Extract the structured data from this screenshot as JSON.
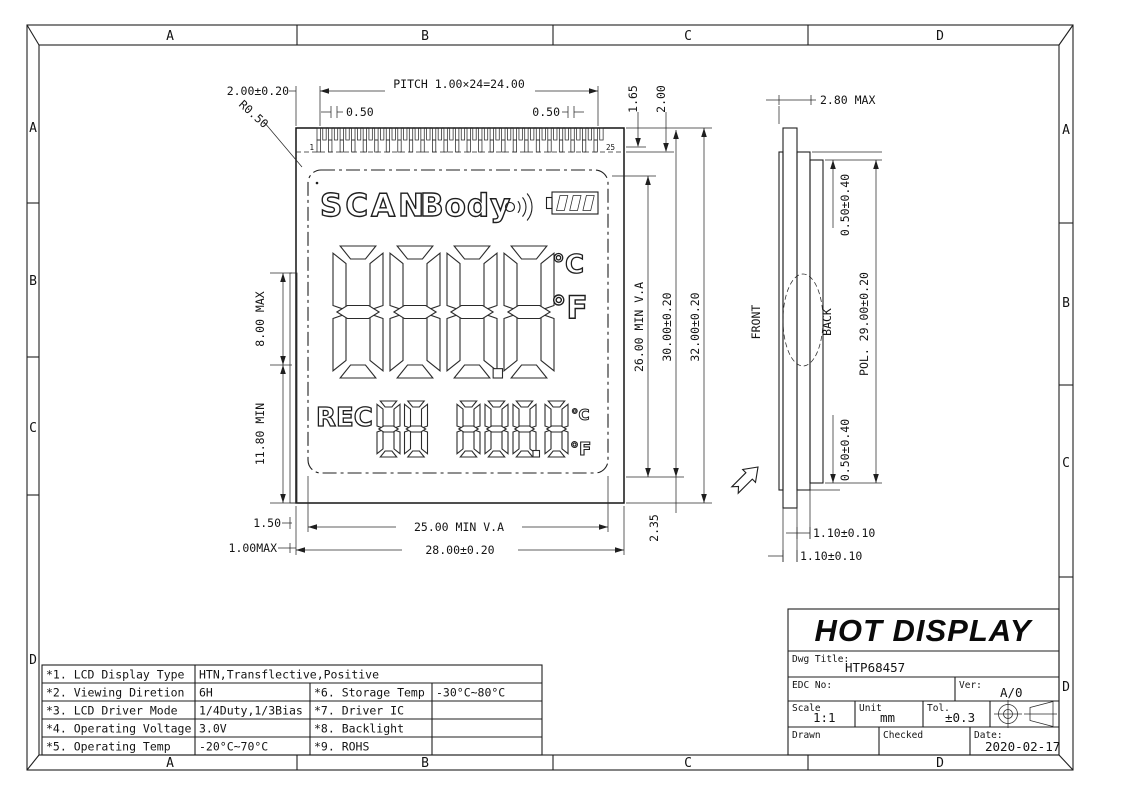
{
  "zones": {
    "top": [
      "A",
      "B",
      "C",
      "D"
    ],
    "bottom": [
      "A",
      "B",
      "C",
      "D"
    ],
    "left": [
      "A",
      "B",
      "C",
      "D"
    ],
    "right": [
      "A",
      "B",
      "C",
      "D"
    ]
  },
  "front_dims": {
    "edge": "2.00±0.20",
    "pitch": "PITCH 1.00×24=24.00",
    "pinw_l": "0.50",
    "pinw_r": "0.50",
    "radius": "R0.50",
    "d165": "1.65",
    "d200": "2.00",
    "h8": "8.00 MAX",
    "h118": "11.80 MIN",
    "d15": "1.50",
    "d1max": "1.00MAX",
    "va_w": "25.00 MIN V.A",
    "w28": "28.00±0.20",
    "va_h": "26.00 MIN V.A",
    "h30": "30.00±0.20",
    "h32": "32.00±0.20",
    "d235": "2.35",
    "pin_first": "1",
    "pin_last": "25"
  },
  "lcd": {
    "scan": "SCAN",
    "body": "Body",
    "rec": "REC",
    "main_digits": "888.8",
    "sub_digits_left": "88",
    "sub_digits_right": "888.8",
    "unit_c_large": "°C",
    "unit_f_large": "°F",
    "unit_c_small": "°C",
    "unit_f_small": "°F",
    "icons": {
      "wireless": "signal-waves-icon",
      "battery": "battery-3-cells-icon"
    }
  },
  "side_dims": {
    "front": "FRONT",
    "back": "BACK",
    "t28": "2.80 MAX",
    "g_top": "0.50±0.40",
    "pol": "POL. 29.00±0.20",
    "g_bot": "0.50±0.40",
    "t11a": "1.10±0.10",
    "t11b": "1.10±0.10"
  },
  "spec_table": {
    "rows": [
      {
        "c1": "*1. LCD Display Type",
        "c2": "HTN,Transflective,Positive",
        "c3": "",
        "c4": ""
      },
      {
        "c1": "*2. Viewing Diretion",
        "c2": "6H",
        "c3": "*6. Storage Temp",
        "c4": "-30°C~80°C"
      },
      {
        "c1": "*3. LCD Driver Mode",
        "c2": "1/4Duty,1/3Bias",
        "c3": "*7. Driver IC",
        "c4": ""
      },
      {
        "c1": "*4. Operating Voltage",
        "c2": "3.0V",
        "c3": "*8. Backlight",
        "c4": ""
      },
      {
        "c1": "*5. Operating Temp",
        "c2": "-20°C~70°C",
        "c3": "*9. ROHS",
        "c4": ""
      }
    ]
  },
  "title_block": {
    "name": "HOT DISPLAY",
    "dwg_title_label": "Dwg Title:",
    "dwg_title": "HTP68457",
    "edc_label": "EDC No:",
    "edc_no": "",
    "ver_label": "Ver:",
    "version": "A/0",
    "scale_label": "Scale",
    "scale": "1:1",
    "unit_label": "Unit",
    "unit": "mm",
    "tol_label": "Tol.",
    "tolerance": "±0.3",
    "drawn_label": "Drawn",
    "checked_label": "Checked",
    "date_label": "Date:",
    "date": "2020-02-17",
    "projection_symbol": "first-angle-projection"
  }
}
